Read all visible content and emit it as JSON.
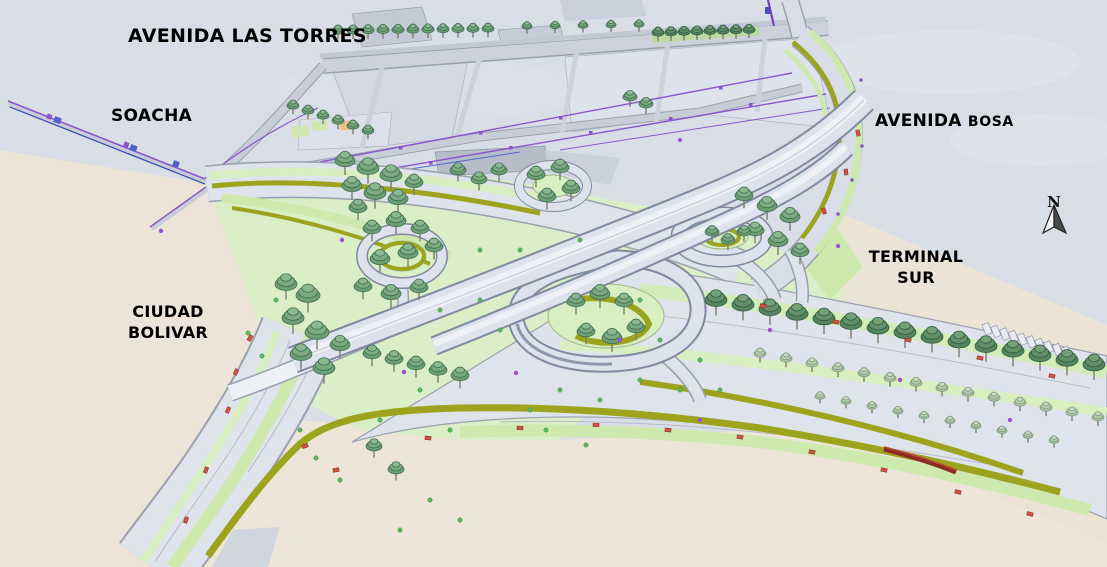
{
  "labels": {
    "avenida_las_torres": "AVENIDA LAS TORRES",
    "soacha": "SOACHA",
    "avenida_bosa_word1": "AVENIDA",
    "avenida_bosa_word2": "BOSA",
    "terminal_sur_line1": "TERMINAL",
    "terminal_sur_line2": "SUR",
    "ciudad_bolivar_line1": "CIUDAD",
    "ciudad_bolivar_line2": "BOLIVAR"
  },
  "compass": {
    "label": "N",
    "icon": "north-arrow-icon"
  },
  "colors": {
    "background_sky": "#d9dee6",
    "ground_beige": "#ece5d9",
    "road_surface": "#dde2ec",
    "road_edge": "#8089a0",
    "grass_light": "#d8efc2",
    "median_olive": "#9ba41c",
    "tree_green": "#7cab81",
    "tree_dark_green": "#639068",
    "utility_purple": "#8a55cc",
    "marker_red": "#cf5344",
    "label_text": "#000000"
  }
}
